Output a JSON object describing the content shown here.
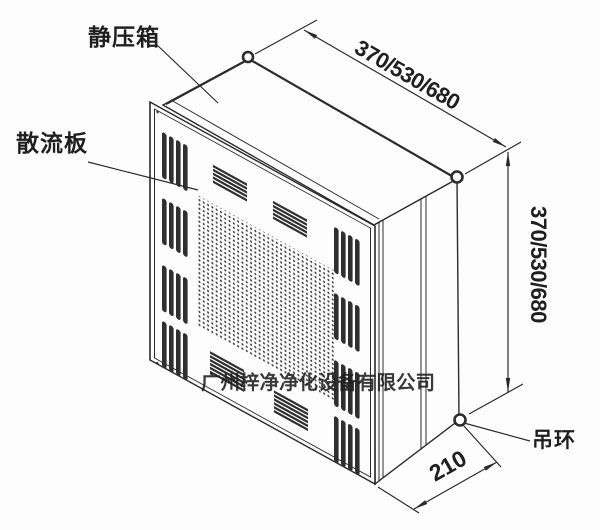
{
  "labels": {
    "static_pressure_box": "静压箱",
    "diffuser_plate": "散流板",
    "lifting_ring": "吊环"
  },
  "dimensions": {
    "top_width": "370/530/680",
    "side_height": "370/530/680",
    "bottom_depth": "210"
  },
  "watermark": {
    "text": "广州梓净净化设备有限公司",
    "color": "#e23b2c"
  },
  "colors": {
    "line": "#2b2b2b",
    "background": "#fdfdfd",
    "louver": "#2f2f2f"
  }
}
